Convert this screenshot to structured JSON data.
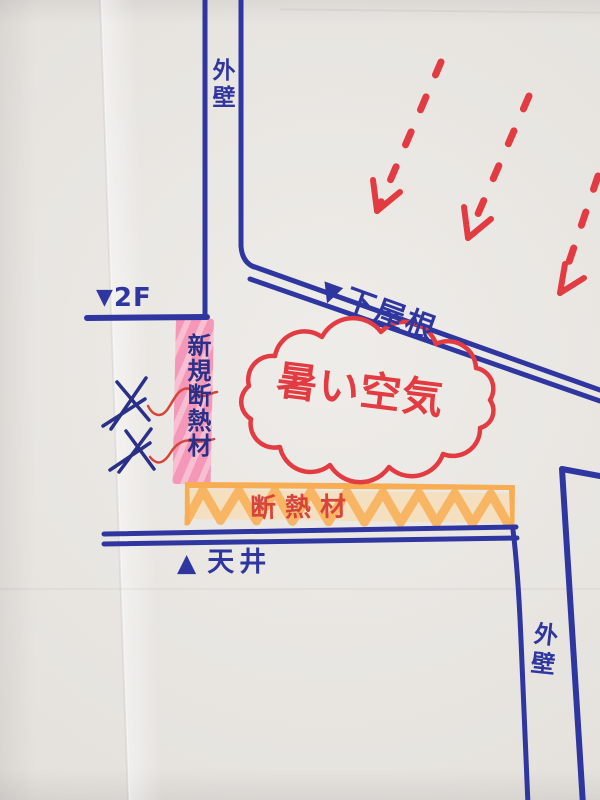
{
  "document_type": "hand-drawn roof insulation sketch",
  "labels": {
    "wall_top": "外壁",
    "floor_2f": {
      "marker": "▼",
      "text": "2F"
    },
    "lower_roof": {
      "marker": "▼",
      "text": "下屋根"
    },
    "hot_air": "暑い空気",
    "new_insulation": "新規断熱材",
    "insulation": "断熱材",
    "ceiling": {
      "marker": "▲",
      "text": "天井"
    },
    "wall_bottom": "外壁"
  },
  "annotations": {
    "x_mark_count": 2,
    "red_arrow_count": 3
  },
  "colors": {
    "paper": "#e9e6e1",
    "blue_marker": "#3036a0",
    "blue_pen": "#2a2f88",
    "red_marker": "#e23b41",
    "red_pen": "#d6453c",
    "pink_highlight": "#f493b6",
    "pink_highlight_light": "#f9bcd0",
    "orange_highlight": "#f8ad52",
    "orange_highlight_light": "#fcd9a4"
  }
}
